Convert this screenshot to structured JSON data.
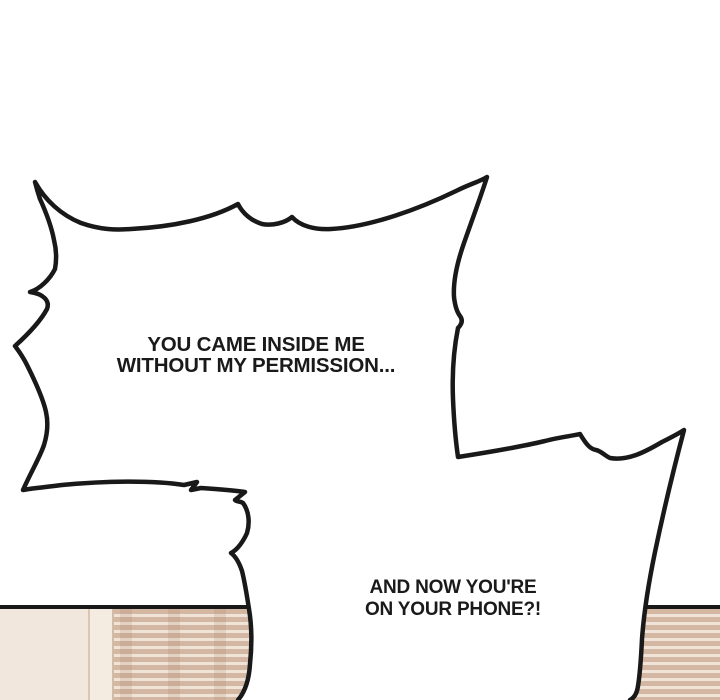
{
  "panel_type": "comic-panel",
  "bubbles": {
    "top": {
      "lines": [
        "YOU CAME INSIDE ME",
        "WITHOUT MY PERMISSION..."
      ]
    },
    "bottom": {
      "lines": [
        "AND NOW YOU'RE",
        "ON YOUR PHONE?!"
      ]
    }
  },
  "scene": {
    "description": "room wall with window blinds behind the speech bubbles",
    "colors": {
      "bubble_outline": "#191919",
      "bubble_fill": "#ffffff",
      "text": "#1a1a1a",
      "wall": "#f1e7dc",
      "frame": "#f4ebe1",
      "blind_slat": "#d4b7a2",
      "blind_gap": "#f0e4d8",
      "panel_edge_line": "#191919"
    }
  }
}
